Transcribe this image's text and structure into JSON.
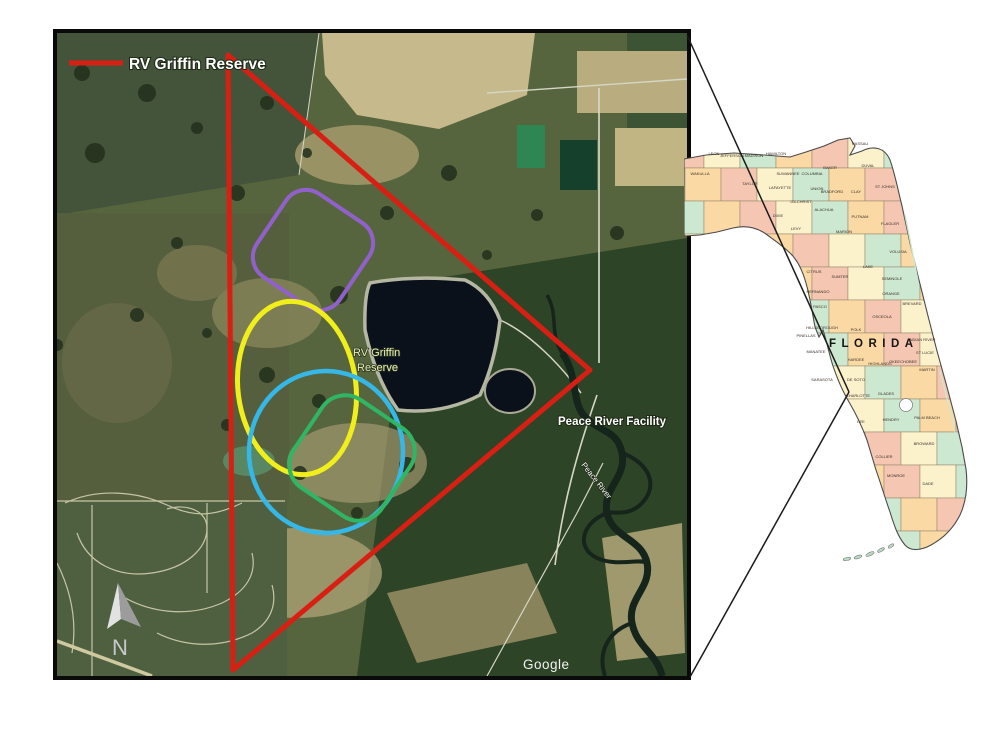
{
  "page": {
    "background": "#ffffff"
  },
  "satellite_map": {
    "legend": {
      "label": "RV Griffin Reserve",
      "line_color": "#d81f14"
    },
    "boundary": {
      "name": "RV Griffin Reserve boundary triangle",
      "color": "#d81f14"
    },
    "labels": {
      "reserve_line1": "RV Griffin",
      "reserve_line2": "Reserve",
      "facility": "Peace River Facility",
      "river": "Peace River",
      "watermark": "Google",
      "north": "N"
    },
    "zones": [
      {
        "name": "purple-zone",
        "shape": "rounded-square",
        "color": "#9161cb"
      },
      {
        "name": "yellow-zone",
        "shape": "ellipse",
        "color": "#f0ef1c"
      },
      {
        "name": "cyan-zone",
        "shape": "ellipse",
        "color": "#35b8e8"
      },
      {
        "name": "green-zone",
        "shape": "rounded-square",
        "color": "#2fb563"
      }
    ]
  },
  "florida_map": {
    "title": "FLORIDA",
    "palette": [
      "#f5c6b2",
      "#fbf2cc",
      "#cde8d0",
      "#fbd9a4"
    ],
    "counties": [
      {
        "name": "WAKULLA",
        "x": 16,
        "y": 42
      },
      {
        "name": "LEON",
        "x": 30,
        "y": 22
      },
      {
        "name": "JEFFERSON",
        "x": 48,
        "y": 24
      },
      {
        "name": "MADISON",
        "x": 70,
        "y": 24
      },
      {
        "name": "HAMILTON",
        "x": 92,
        "y": 22
      },
      {
        "name": "SUWANNEE",
        "x": 104,
        "y": 42
      },
      {
        "name": "TAYLOR",
        "x": 66,
        "y": 52
      },
      {
        "name": "LAFAYETTE",
        "x": 96,
        "y": 56
      },
      {
        "name": "DIXIE",
        "x": 94,
        "y": 84
      },
      {
        "name": "COLUMBIA",
        "x": 128,
        "y": 42
      },
      {
        "name": "BAKER",
        "x": 146,
        "y": 36
      },
      {
        "name": "NASSAU",
        "x": 176,
        "y": 12
      },
      {
        "name": "DUVAL",
        "x": 184,
        "y": 34
      },
      {
        "name": "UNION",
        "x": 133,
        "y": 57
      },
      {
        "name": "BRADFORD",
        "x": 148,
        "y": 60
      },
      {
        "name": "CLAY",
        "x": 172,
        "y": 60
      },
      {
        "name": "ST JOHNS",
        "x": 201,
        "y": 55
      },
      {
        "name": "ALACHUA",
        "x": 140,
        "y": 78
      },
      {
        "name": "PUTNAM",
        "x": 176,
        "y": 85
      },
      {
        "name": "FLAGLER",
        "x": 206,
        "y": 92
      },
      {
        "name": "GILCHRIST",
        "x": 117,
        "y": 70
      },
      {
        "name": "LEVY",
        "x": 112,
        "y": 97
      },
      {
        "name": "MARION",
        "x": 160,
        "y": 100
      },
      {
        "name": "VOLUSIA",
        "x": 214,
        "y": 120
      },
      {
        "name": "LAKE",
        "x": 184,
        "y": 135
      },
      {
        "name": "CITRUS",
        "x": 130,
        "y": 140
      },
      {
        "name": "SUMTER",
        "x": 156,
        "y": 145
      },
      {
        "name": "SEMINOLE",
        "x": 208,
        "y": 147
      },
      {
        "name": "ORANGE",
        "x": 207,
        "y": 162
      },
      {
        "name": "HERNANDO",
        "x": 134,
        "y": 160
      },
      {
        "name": "PASCO",
        "x": 136,
        "y": 175
      },
      {
        "name": "OSCEOLA",
        "x": 198,
        "y": 185
      },
      {
        "name": "POLK",
        "x": 172,
        "y": 198
      },
      {
        "name": "HILLSBOROUGH",
        "x": 138,
        "y": 196
      },
      {
        "name": "PINELLAS",
        "x": 122,
        "y": 204
      },
      {
        "name": "BREVARD",
        "x": 228,
        "y": 172
      },
      {
        "name": "INDIAN RIVER",
        "x": 238,
        "y": 208
      },
      {
        "name": "ST LUCIE",
        "x": 241,
        "y": 221
      },
      {
        "name": "OKEECHOBEE",
        "x": 219,
        "y": 230
      },
      {
        "name": "HIGHLANDS",
        "x": 196,
        "y": 232
      },
      {
        "name": "HARDEE",
        "x": 172,
        "y": 228
      },
      {
        "name": "MANATEE",
        "x": 132,
        "y": 220
      },
      {
        "name": "SARASOTA",
        "x": 138,
        "y": 248
      },
      {
        "name": "DE SOTO",
        "x": 172,
        "y": 248
      },
      {
        "name": "CHARLOTTE",
        "x": 174,
        "y": 264
      },
      {
        "name": "GLADES",
        "x": 202,
        "y": 262
      },
      {
        "name": "MARTIN",
        "x": 243,
        "y": 238
      },
      {
        "name": "PALM BEACH",
        "x": 243,
        "y": 286
      },
      {
        "name": "HENDRY",
        "x": 207,
        "y": 288
      },
      {
        "name": "LEE",
        "x": 177,
        "y": 290
      },
      {
        "name": "BROWARD",
        "x": 240,
        "y": 312
      },
      {
        "name": "COLLIER",
        "x": 200,
        "y": 325
      },
      {
        "name": "DADE",
        "x": 244,
        "y": 352
      },
      {
        "name": "MONROE",
        "x": 212,
        "y": 344
      }
    ]
  },
  "callout": {
    "description": "location callout lines from aerial image to DeSoto County",
    "color": "#1b1b1b"
  }
}
